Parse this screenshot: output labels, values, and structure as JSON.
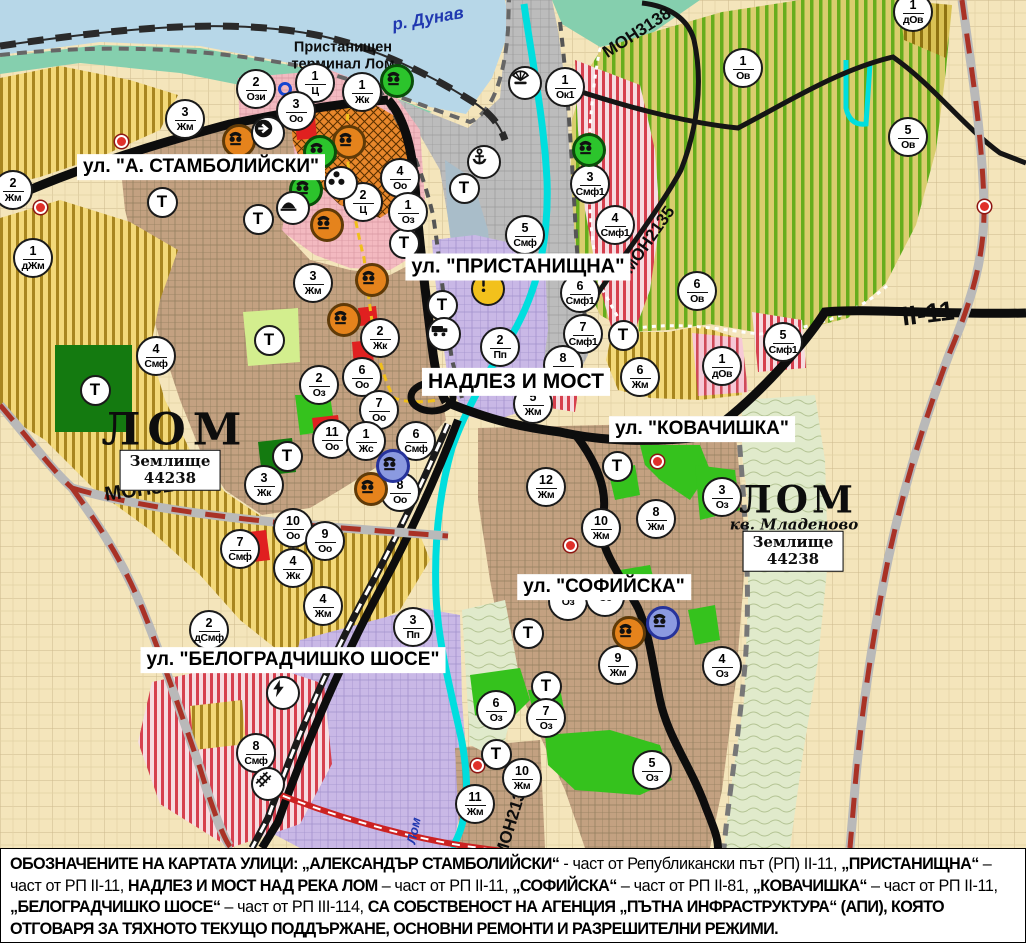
{
  "palette": {
    "water": "#b7d7e8",
    "teal_shore": "#85cfae",
    "port_gray": "#bcbcbc",
    "harbor_basin": "#a9bdc9",
    "red_stripe": "#d6404e",
    "stripe_bg": "#f6dce1",
    "urban_brown": "#c3a181",
    "field_yellow": "#f3d979",
    "vineyard_base": "#d9cd6e",
    "vineyard_stripe": "#66ad1d",
    "purple_zone": "#c9b8e6",
    "beige": "#f4e5bb",
    "green_zone": "#35c21d",
    "dark_green": "#147a10",
    "river_cyan": "#00dede",
    "road_black": "#111111",
    "boundary_red": "#a93226",
    "pink_zone": "#f3b9c0",
    "orange_zone": "#e8872b",
    "label_blue": "#2038b0",
    "terrain_green": "#e0eacb"
  },
  "labels": {
    "streets": [
      {
        "id": "stamboliyski",
        "text": "ул. \"А. СТАМБОЛИЙСКИ\"",
        "x": 201,
        "y": 167,
        "fs": 19
      },
      {
        "id": "pristanishtna",
        "text": "ул. \"ПРИСТАНИЩНА\"",
        "x": 518,
        "y": 267,
        "fs": 20
      },
      {
        "id": "nadlez-i-most",
        "text": "НАДЛЕЗ И МОСТ",
        "x": 516,
        "y": 382,
        "fs": 21
      },
      {
        "id": "kovachishka",
        "text": "ул. \"КОВАЧИШКА\"",
        "x": 702,
        "y": 429,
        "fs": 19
      },
      {
        "id": "sofiyska",
        "text": "ул. \"СОФИЙСКА\"",
        "x": 604,
        "y": 587,
        "fs": 19
      },
      {
        "id": "belogradchishko-shose",
        "text": "ул. \"БЕЛОГРАДЧИШКО ШОСЕ\"",
        "x": 293,
        "y": 660,
        "fs": 19
      }
    ],
    "areas": [
      {
        "id": "port-terminal",
        "text": "Пристанищен\nтерминал Лом",
        "x": 343,
        "y": 56,
        "fs": 14.5,
        "cls": ""
      },
      {
        "id": "lom-west",
        "text": "ЛОМ",
        "x": 175,
        "y": 431,
        "fs": 44,
        "cls": "serif",
        "ls": 7
      },
      {
        "id": "zemlishte-west",
        "text": "Землище\n44238",
        "x": 170,
        "y": 470,
        "fs": 15,
        "cls": "serif boxed"
      },
      {
        "id": "lom-east",
        "text": "ЛОМ",
        "x": 798,
        "y": 500,
        "fs": 37,
        "cls": "serif",
        "ls": 4
      },
      {
        "id": "kv-mladenovo",
        "text": "кв. Младеново",
        "x": 794,
        "y": 525,
        "fs": 15,
        "cls": "serif",
        "italic": true
      },
      {
        "id": "zemlishte-east",
        "text": "Землище\n44238",
        "x": 793,
        "y": 551,
        "fs": 15,
        "cls": "serif boxed"
      }
    ],
    "roads": [
      {
        "id": "mon3139",
        "text": "МОН3139",
        "x": 150,
        "y": 489,
        "rot": -8,
        "fs": 20
      },
      {
        "id": "mon3138",
        "text": "МОН3138",
        "x": 637,
        "y": 33,
        "rot": -33,
        "fs": 17
      },
      {
        "id": "mon2135",
        "text": "МОН2135",
        "x": 649,
        "y": 240,
        "rot": -55,
        "fs": 17
      },
      {
        "id": "mon2136",
        "text": "МОН2136",
        "x": 512,
        "y": 820,
        "rot": -73,
        "fs": 17
      },
      {
        "id": "ii-11",
        "text": "II-11",
        "x": 928,
        "y": 314,
        "rot": -7,
        "fs": 27
      }
    ],
    "waters": [
      {
        "id": "danube",
        "text": "р. Дунав",
        "x": 428,
        "y": 19,
        "rot": -10,
        "fs": 17
      },
      {
        "id": "lom-river",
        "text": "р. Лом",
        "x": 412,
        "y": 838,
        "rot": -78,
        "fs": 13
      }
    ]
  },
  "markers": {
    "transport_label": "Т",
    "zones": [
      {
        "n": "2",
        "c": "Ози",
        "x": 256,
        "y": 89
      },
      {
        "n": "1",
        "c": "Ц",
        "x": 315,
        "y": 83
      },
      {
        "n": "1",
        "c": "Жк",
        "x": 362,
        "y": 92
      },
      {
        "n": "3",
        "c": "Оо",
        "x": 296,
        "y": 111
      },
      {
        "n": "3",
        "c": "Жм",
        "x": 185,
        "y": 119
      },
      {
        "n": "2",
        "c": "Жм",
        "x": 13,
        "y": 190
      },
      {
        "n": "1",
        "c": "дЖм",
        "x": 33,
        "y": 258
      },
      {
        "n": "1",
        "c": "Ок1",
        "x": 565,
        "y": 87
      },
      {
        "n": "3",
        "c": "Смф1",
        "x": 590,
        "y": 184
      },
      {
        "n": "4",
        "c": "Смф1",
        "x": 615,
        "y": 225
      },
      {
        "n": "4",
        "c": "Оо",
        "x": 400,
        "y": 178
      },
      {
        "n": "2",
        "c": "Ц",
        "x": 363,
        "y": 202
      },
      {
        "n": "1",
        "c": "Оз",
        "x": 408,
        "y": 212
      },
      {
        "n": "5",
        "c": "Смф",
        "x": 525,
        "y": 235
      },
      {
        "n": "2",
        "c": "Пп",
        "x": 500,
        "y": 347
      },
      {
        "n": "6",
        "c": "Смф1",
        "x": 580,
        "y": 293
      },
      {
        "n": "7",
        "c": "Смф1",
        "x": 583,
        "y": 334
      },
      {
        "n": "8",
        "c": "Жм",
        "x": 563,
        "y": 365
      },
      {
        "n": "5",
        "c": "Жм",
        "x": 533,
        "y": 404
      },
      {
        "n": "6",
        "c": "Жм",
        "x": 640,
        "y": 377
      },
      {
        "n": "12",
        "c": "Жм",
        "x": 546,
        "y": 487
      },
      {
        "n": "10",
        "c": "Жм",
        "x": 601,
        "y": 528
      },
      {
        "n": "8",
        "c": "Жм",
        "x": 656,
        "y": 519
      },
      {
        "n": "3",
        "c": "Оз",
        "x": 722,
        "y": 497
      },
      {
        "n": "3",
        "c": "Жм",
        "x": 313,
        "y": 283
      },
      {
        "n": "2",
        "c": "Жк",
        "x": 380,
        "y": 338
      },
      {
        "n": "6",
        "c": "Оо",
        "x": 362,
        "y": 377
      },
      {
        "n": "2",
        "c": "Оз",
        "x": 319,
        "y": 385
      },
      {
        "n": "7",
        "c": "Оо",
        "x": 379,
        "y": 410
      },
      {
        "n": "11",
        "c": "Оо",
        "x": 332,
        "y": 439
      },
      {
        "n": "1",
        "c": "Жс",
        "x": 366,
        "y": 441
      },
      {
        "n": "6",
        "c": "Смф",
        "x": 416,
        "y": 441
      },
      {
        "n": "3",
        "c": "Жк",
        "x": 264,
        "y": 485
      },
      {
        "n": "8",
        "c": "Оо",
        "x": 400,
        "y": 492
      },
      {
        "n": "10",
        "c": "Оо",
        "x": 293,
        "y": 528
      },
      {
        "n": "9",
        "c": "Оо",
        "x": 325,
        "y": 541
      },
      {
        "n": "4",
        "c": "Жк",
        "x": 293,
        "y": 568
      },
      {
        "n": "4",
        "c": "Жм",
        "x": 323,
        "y": 606
      },
      {
        "n": "7",
        "c": "Смф",
        "x": 240,
        "y": 549
      },
      {
        "n": "2",
        "c": "дСмф",
        "x": 209,
        "y": 630
      },
      {
        "n": "3",
        "c": "Пп",
        "x": 413,
        "y": 627
      },
      {
        "n": "8",
        "c": "Смф",
        "x": 256,
        "y": 753
      },
      {
        "n": "4",
        "c": "Смф",
        "x": 156,
        "y": 356
      },
      {
        "n": "6",
        "c": "Ов",
        "x": 697,
        "y": 291
      },
      {
        "n": "1",
        "c": "дОв",
        "x": 722,
        "y": 366
      },
      {
        "n": "5",
        "c": "Смф1",
        "x": 783,
        "y": 342
      },
      {
        "n": "1",
        "c": "Ов",
        "x": 743,
        "y": 68
      },
      {
        "n": "5",
        "c": "Ов",
        "x": 908,
        "y": 137
      },
      {
        "n": "1",
        "c": "дОв",
        "x": 913,
        "y": 12
      },
      {
        "n": "9",
        "c": "Жм",
        "x": 618,
        "y": 665
      },
      {
        "n": "4",
        "c": "Оз",
        "x": 722,
        "y": 666
      },
      {
        "n": "6",
        "c": "Оз",
        "x": 496,
        "y": 710
      },
      {
        "n": "7",
        "c": "Оз",
        "x": 546,
        "y": 718
      },
      {
        "n": "5",
        "c": "Оз",
        "x": 652,
        "y": 770
      },
      {
        "n": "10",
        "c": "Жм",
        "x": 522,
        "y": 778
      },
      {
        "n": "11",
        "c": "Жм",
        "x": 475,
        "y": 804
      },
      {
        "n": "",
        "c": "Оз",
        "x": 568,
        "y": 601
      },
      {
        "n": "",
        "c": "Оз",
        "x": 605,
        "y": 597
      }
    ],
    "transport": [
      {
        "x": 162,
        "y": 202
      },
      {
        "x": 258,
        "y": 219
      },
      {
        "x": 269,
        "y": 340
      },
      {
        "x": 95,
        "y": 390
      },
      {
        "x": 287,
        "y": 456
      },
      {
        "x": 617,
        "y": 466
      },
      {
        "x": 528,
        "y": 633
      },
      {
        "x": 546,
        "y": 686
      },
      {
        "x": 496,
        "y": 754
      },
      {
        "x": 442,
        "y": 305
      },
      {
        "x": 404,
        "y": 243
      },
      {
        "x": 464,
        "y": 188
      },
      {
        "x": 623,
        "y": 335
      }
    ],
    "icons": [
      {
        "type": "monument",
        "variant": "orange",
        "x": 239,
        "y": 141
      },
      {
        "type": "monument",
        "variant": "orange",
        "x": 349,
        "y": 142
      },
      {
        "type": "monument",
        "variant": "orange",
        "x": 327,
        "y": 225
      },
      {
        "type": "monument",
        "variant": "orange",
        "x": 372,
        "y": 280
      },
      {
        "type": "monument",
        "variant": "orange",
        "x": 344,
        "y": 320
      },
      {
        "type": "monument",
        "variant": "orange",
        "x": 371,
        "y": 489
      },
      {
        "type": "monument",
        "variant": "orange",
        "x": 629,
        "y": 633
      },
      {
        "type": "monument",
        "variant": "green",
        "x": 397,
        "y": 81
      },
      {
        "type": "monument",
        "variant": "green",
        "x": 320,
        "y": 152
      },
      {
        "type": "monument",
        "variant": "green",
        "x": 306,
        "y": 190
      },
      {
        "type": "monument",
        "variant": "green",
        "x": 589,
        "y": 150
      },
      {
        "type": "monument",
        "variant": "blue",
        "x": 393,
        "y": 466
      },
      {
        "type": "monument",
        "variant": "blue",
        "x": 663,
        "y": 623
      },
      {
        "type": "people",
        "variant": "white",
        "x": 341,
        "y": 183
      },
      {
        "type": "boat",
        "variant": "white",
        "x": 293,
        "y": 208
      },
      {
        "type": "anchor",
        "variant": "white",
        "x": 484,
        "y": 162
      },
      {
        "type": "fan",
        "variant": "white",
        "x": 525,
        "y": 83
      },
      {
        "type": "arrow",
        "variant": "white",
        "x": 268,
        "y": 133
      },
      {
        "type": "truck",
        "variant": "white",
        "x": 444,
        "y": 334
      },
      {
        "type": "lightning",
        "variant": "white",
        "x": 283,
        "y": 693
      },
      {
        "type": "railway",
        "variant": "white",
        "x": 268,
        "y": 784
      },
      {
        "type": "exclaim",
        "variant": "yellow",
        "x": 488,
        "y": 289
      }
    ],
    "red_dots": [
      {
        "x": 121,
        "y": 141
      },
      {
        "x": 304,
        "y": 196
      },
      {
        "x": 40,
        "y": 207
      },
      {
        "x": 657,
        "y": 461
      },
      {
        "x": 570,
        "y": 545
      },
      {
        "x": 477,
        "y": 765
      },
      {
        "x": 984,
        "y": 206
      }
    ],
    "blue_rings": [
      {
        "x": 285,
        "y": 89
      }
    ]
  },
  "note": {
    "segments": [
      {
        "b": true,
        "t": "ОБОЗНАЧЕНИТЕ НА КАРТАТА УЛИЦИ: „АЛЕКСАНДЪР СТАМБОЛИЙСКИ“"
      },
      {
        "b": false,
        "t": " - част от Републикански път (РП) II-11, "
      },
      {
        "b": true,
        "t": "„ПРИСТАНИЩНА“"
      },
      {
        "b": false,
        "t": " – част от РП II-11, "
      },
      {
        "b": true,
        "t": "НАДЛЕЗ И МОСТ НАД РЕКА ЛОМ"
      },
      {
        "b": false,
        "t": " – част от РП II-11, "
      },
      {
        "b": true,
        "t": "„СОФИЙСКА“"
      },
      {
        "b": false,
        "t": " – част от РП II-81, "
      },
      {
        "b": true,
        "t": "„КОВАЧИШКА“"
      },
      {
        "b": false,
        "t": " – част от РП II-11, "
      },
      {
        "b": true,
        "t": "„БЕЛОГРАДЧИШКО ШОСЕ“"
      },
      {
        "b": false,
        "t": " – част от РП III-114, "
      },
      {
        "b": true,
        "t": "СА СОБСТВЕНОСТ НА АГЕНЦИЯ „ПЪТНА ИНФРАСТРУКТУРА“ (АПИ), КОЯТО ОТГОВАРЯ ЗА ТЯХНОТО ТЕКУЩО ПОДДЪРЖАНЕ, ОСНОВНИ РЕМОНТИ И РАЗРЕШИТЕЛНИ РЕЖИМИ."
      }
    ]
  }
}
